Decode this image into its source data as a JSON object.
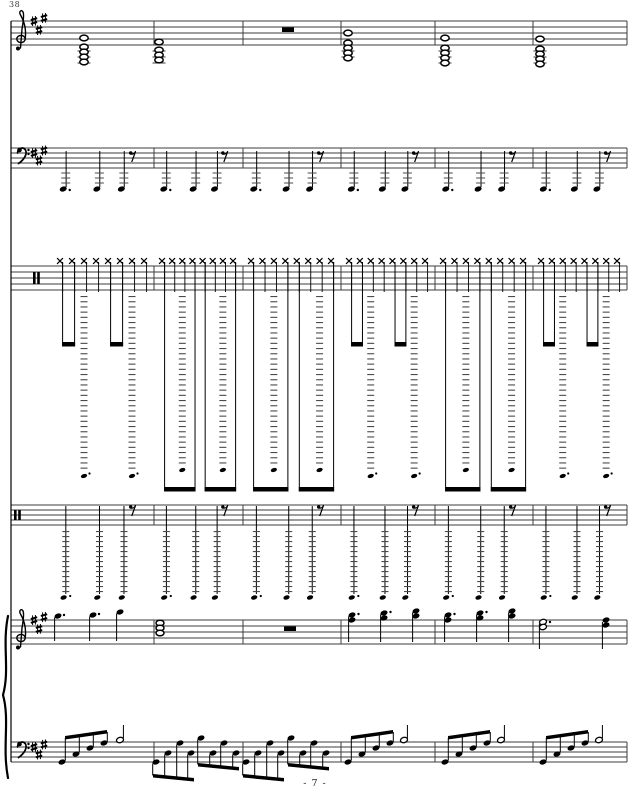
{
  "page": {
    "measure_number": "38",
    "page_number": "- 7 -",
    "colors": {
      "ink": "#000000",
      "staff": "#3c3c3c",
      "ledger": "#4a4a4a",
      "paper": "#ffffff"
    }
  },
  "score": {
    "width": 630,
    "height": 792,
    "left_line_x": 11,
    "right_line_x": 627,
    "top_y": 21,
    "bottom_y": 762,
    "barlines": [
      154,
      243,
      341,
      435,
      533
    ],
    "measures": [
      [
        52,
        154
      ],
      [
        154,
        243
      ],
      [
        243,
        341
      ],
      [
        341,
        435
      ],
      [
        435,
        533
      ],
      [
        533,
        627
      ]
    ],
    "staves": [
      {
        "name": "ensemble-treble",
        "top": 21,
        "gap": 6,
        "clef": "treble",
        "clef_x": 21,
        "sharp_xs": [
          34,
          39,
          44
        ],
        "sharp_ys": [
          21,
          30,
          18
        ]
      },
      {
        "name": "ensemble-bass",
        "top": 148,
        "gap": 5,
        "clef": "bass",
        "clef_x": 18,
        "sharp_xs": [
          34,
          39,
          44
        ],
        "sharp_ys": [
          153,
          160.5,
          150.5
        ]
      },
      {
        "name": "drums-upper",
        "top": 266,
        "gap": 6,
        "clef": "perc",
        "clef_x": 33
      },
      {
        "name": "drums-lower",
        "top": 505,
        "gap": 5,
        "clef": "perc",
        "clef_x": 14
      },
      {
        "name": "piano-treble",
        "top": 620,
        "gap": 6,
        "clef": "treble",
        "clef_x": 21,
        "sharp_xs": [
          34,
          39,
          44
        ],
        "sharp_ys": [
          620,
          629,
          617
        ]
      },
      {
        "name": "piano-bass",
        "top": 742,
        "gap": 5,
        "clef": "bass",
        "clef_x": 18,
        "sharp_xs": [
          34,
          39,
          44
        ],
        "sharp_ys": [
          747,
          754.5,
          744.5
        ]
      }
    ],
    "ensemble_treble": {
      "chords": [
        {
          "x": 84,
          "heads": [
            38,
            47,
            52,
            57,
            62
          ]
        },
        {
          "x": 159,
          "heads": [
            42,
            50,
            55,
            60
          ]
        },
        {
          "x": 348,
          "heads": [
            33,
            43,
            48,
            53,
            58
          ]
        },
        {
          "x": 445,
          "heads": [
            38,
            48,
            53,
            58,
            63
          ]
        },
        {
          "x": 540,
          "heads": [
            39,
            49,
            54,
            59,
            64
          ]
        }
      ],
      "ledger_ys": [
        51,
        57,
        63
      ],
      "whole_rest_x": 288,
      "whole_rest_y": 27
    },
    "ensemble_bass": {
      "note_fracs": [
        0.11,
        0.44,
        0.68
      ],
      "rest_frac": 0.76,
      "head_y": 189,
      "stem_top": 151,
      "ledger_ys": [
        173,
        178,
        183
      ],
      "rest_y": 150
    },
    "drums_upper": {
      "x_y": 261,
      "styles": [
        "short",
        "long",
        "long",
        "short",
        "long",
        "short"
      ],
      "stem_bottom_staff": 292,
      "short_beam_y": 342,
      "long_beam_y": 487,
      "beam_h": 4.5,
      "dash_top": 296,
      "dash_step": 5.2,
      "short": {
        "dash_bottom": 470,
        "head_y": 476,
        "dotted": true
      },
      "long": {
        "dash_bottom": 464,
        "head_y": 470,
        "dotted": false
      }
    },
    "drums_lower": {
      "note_fracs": [
        0.11,
        0.44,
        0.68
      ],
      "rest_frac": 0.76,
      "stem_top": 506,
      "stem_bottom": 594,
      "dash_top": 531,
      "dash_bottom": 591,
      "dash_step": 5,
      "head_y": 597.5,
      "rest_y": 504
    },
    "piano_treble": {
      "m1_notes": [
        {
          "x": 58,
          "y": 616,
          "dot": true
        },
        {
          "x": 93,
          "y": 615,
          "dot": true
        },
        {
          "x": 120,
          "y": 612,
          "dot": false
        }
      ],
      "m2_chord": {
        "x": 160,
        "heads": [
          623,
          628,
          633
        ]
      },
      "whole_rest_x": 290,
      "whole_rest_y": 626,
      "chords": [
        {
          "x": 352,
          "heads": [
            615,
            620
          ],
          "dot": true
        },
        {
          "x": 384,
          "heads": [
            613,
            618
          ],
          "dot": true
        },
        {
          "x": 416,
          "heads": [
            611,
            616
          ],
          "dot": false
        },
        {
          "x": 448,
          "heads": [
            615,
            620
          ],
          "dot": true
        },
        {
          "x": 480,
          "heads": [
            613,
            618
          ],
          "dot": true
        },
        {
          "x": 512,
          "heads": [
            611,
            616
          ],
          "dot": false
        }
      ],
      "m6_half": {
        "x": 543,
        "heads": [
          622,
          627
        ],
        "dot": true,
        "stem_bottom": 649
      },
      "m6_final": {
        "x": 606,
        "heads": [
          620,
          625
        ],
        "stem_bottom": 649
      },
      "stem_bottom": 641
    },
    "piano_bass": {
      "arpeggios": [
        {
          "notes": [
            [
              62,
              762
            ],
            [
              76,
              754
            ],
            [
              90,
              748
            ],
            [
              104,
              743
            ]
          ],
          "beam": [
            65,
            736,
            107,
            730
          ],
          "half": [
            120,
            740
          ]
        },
        {
          "notes": [
            [
              348,
              762
            ],
            [
              362,
              754
            ],
            [
              376,
              748
            ],
            [
              390,
              743
            ]
          ],
          "beam": [
            351,
            736,
            393,
            730
          ],
          "half": [
            404,
            740
          ]
        },
        {
          "notes": [
            [
              445,
              762
            ],
            [
              459,
              754
            ],
            [
              473,
              748
            ],
            [
              487,
              743
            ]
          ],
          "beam": [
            448,
            736,
            490,
            730
          ],
          "half": [
            501,
            740
          ]
        },
        {
          "notes": [
            [
              543,
              762
            ],
            [
              557,
              754
            ],
            [
              571,
              748
            ],
            [
              585,
              743
            ]
          ],
          "beam": [
            546,
            736,
            588,
            730
          ],
          "half": [
            599,
            740
          ]
        }
      ],
      "runs": [
        {
          "groups": [
            {
              "notes": [
                [
                  156,
                  762
                ],
                [
                  168,
                  753
                ],
                [
                  180,
                  743
                ],
                [
                  191,
                  753
                ]
              ],
              "beam": [
                153,
                774,
                194,
                778
              ]
            },
            {
              "notes": [
                [
                  201,
                  738
                ],
                [
                  213,
                  753
                ],
                [
                  224,
                  743
                ],
                [
                  236,
                  753
                ]
              ],
              "beam": [
                198,
                763,
                239,
                767
              ]
            }
          ]
        },
        {
          "groups": [
            {
              "notes": [
                [
                  246,
                  762
                ],
                [
                  258,
                  753
                ],
                [
                  270,
                  743
                ],
                [
                  281,
                  753
                ]
              ],
              "beam": [
                243,
                774,
                284,
                778
              ]
            },
            {
              "notes": [
                [
                  291,
                  738
                ],
                [
                  303,
                  753
                ],
                [
                  314,
                  743
                ],
                [
                  326,
                  753
                ]
              ],
              "beam": [
                288,
                763,
                329,
                767
              ]
            }
          ]
        }
      ]
    }
  }
}
